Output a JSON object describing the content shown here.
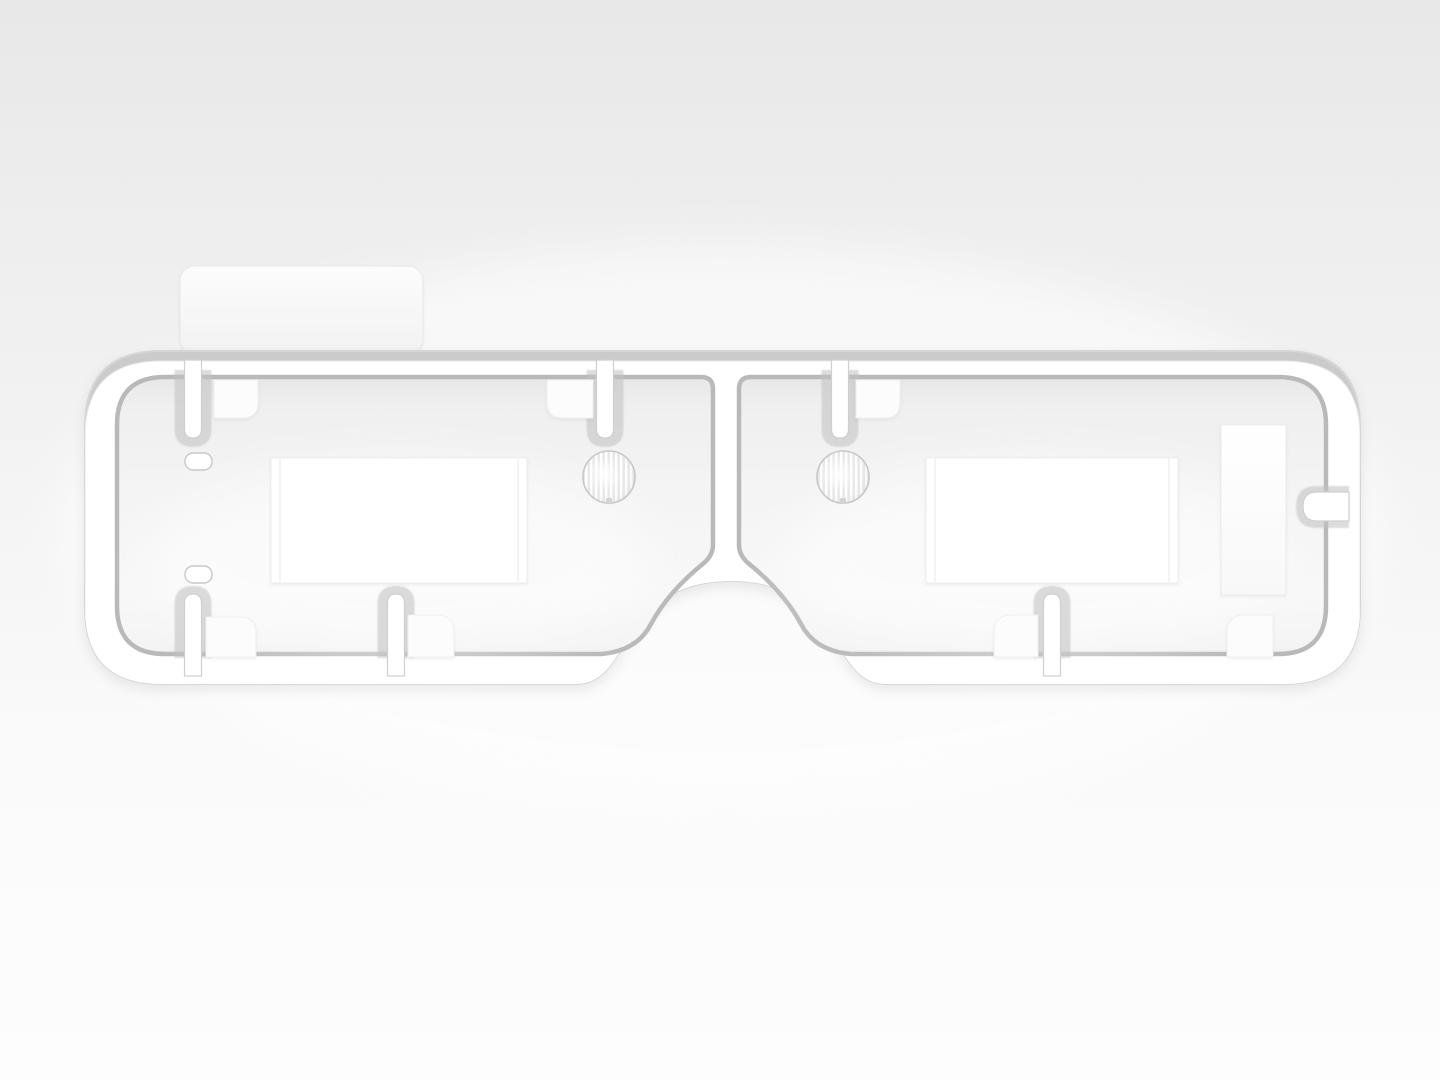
{
  "meta": {
    "kind": "3d-product-render",
    "subject": "white injection-molded eyewear-style frame / gasket part",
    "view": "front orthographic on neutral studio backdrop",
    "visible_text": "none"
  },
  "palette": {
    "bg_top": "#e8e8e8",
    "bg_mid": "#f3f3f3",
    "bg_bottom": "#fdfdfd",
    "frame_bevel": "#cbcbcb",
    "frame_face": "#ffffff",
    "frame_edge": "#d6d6d6",
    "groove": "#b9b9b9",
    "stub_halo": "#c3c3c3",
    "stub_edge": "#cfcfcf",
    "interior_top": "#e7e7e7",
    "interior_hi": "#efefef",
    "interior_mid": "#f4f4f4",
    "interior_low": "#f8f8f8",
    "interior_end": "#efefef",
    "pad": "#fcfcfc",
    "pad_edge": "#f0f0f0",
    "white": "#ffffff",
    "rect_edge": "#ececec",
    "seam": "#f2f2f2",
    "lens_ring": "#c6c6c6",
    "lens_stripe": "#e8e8e8",
    "lens_fill": "#f4f4f4",
    "lens_notch": "#d4d4d4",
    "pill_edge": "#c8c8c8",
    "tab_top": "#fcfcfc",
    "tab_bottom": "#f2f2f2",
    "tab_edge": "#e9e9e9"
  },
  "scene": {
    "parts": [
      {
        "name": "outer-frame",
        "desc": "rounded rectangular tube frame with nose-bridge arch cutout at bottom center"
      },
      {
        "name": "top-tab",
        "desc": "rounded tab protruding above frame at upper left"
      },
      {
        "name": "left-eye-panel",
        "desc": "recessed interior panel, left"
      },
      {
        "name": "right-eye-panel",
        "desc": "recessed interior panel, right"
      },
      {
        "name": "center-divider",
        "desc": "vertical rib between panels above nose arch"
      },
      {
        "name": "top-stubs",
        "count": 3,
        "x_centers": [
          193,
          605,
          840
        ]
      },
      {
        "name": "bottom-stubs",
        "count": 3,
        "x_centers": [
          193,
          396,
          1052
        ]
      },
      {
        "name": "corner-pads",
        "count": 7
      },
      {
        "name": "lens-disc-left",
        "center": [
          609,
          477
        ],
        "radius": 26,
        "texture": "vertical striations"
      },
      {
        "name": "lens-disc-right",
        "center": [
          843,
          477
        ],
        "radius": 26,
        "texture": "vertical striations"
      },
      {
        "name": "window-left",
        "rect": [
          271,
          458,
          256,
          125
        ]
      },
      {
        "name": "window-right",
        "rect": [
          926,
          458,
          252,
          125
        ]
      },
      {
        "name": "side-plate-right",
        "rect": [
          1221,
          425,
          65,
          170
        ]
      },
      {
        "name": "side-notch-right",
        "desc": "rounded slot in right wall",
        "center_y": 507
      },
      {
        "name": "pill-slots-left",
        "count": 2,
        "positions": [
          [
            185,
            453
          ],
          [
            185,
            566
          ]
        ]
      }
    ]
  }
}
